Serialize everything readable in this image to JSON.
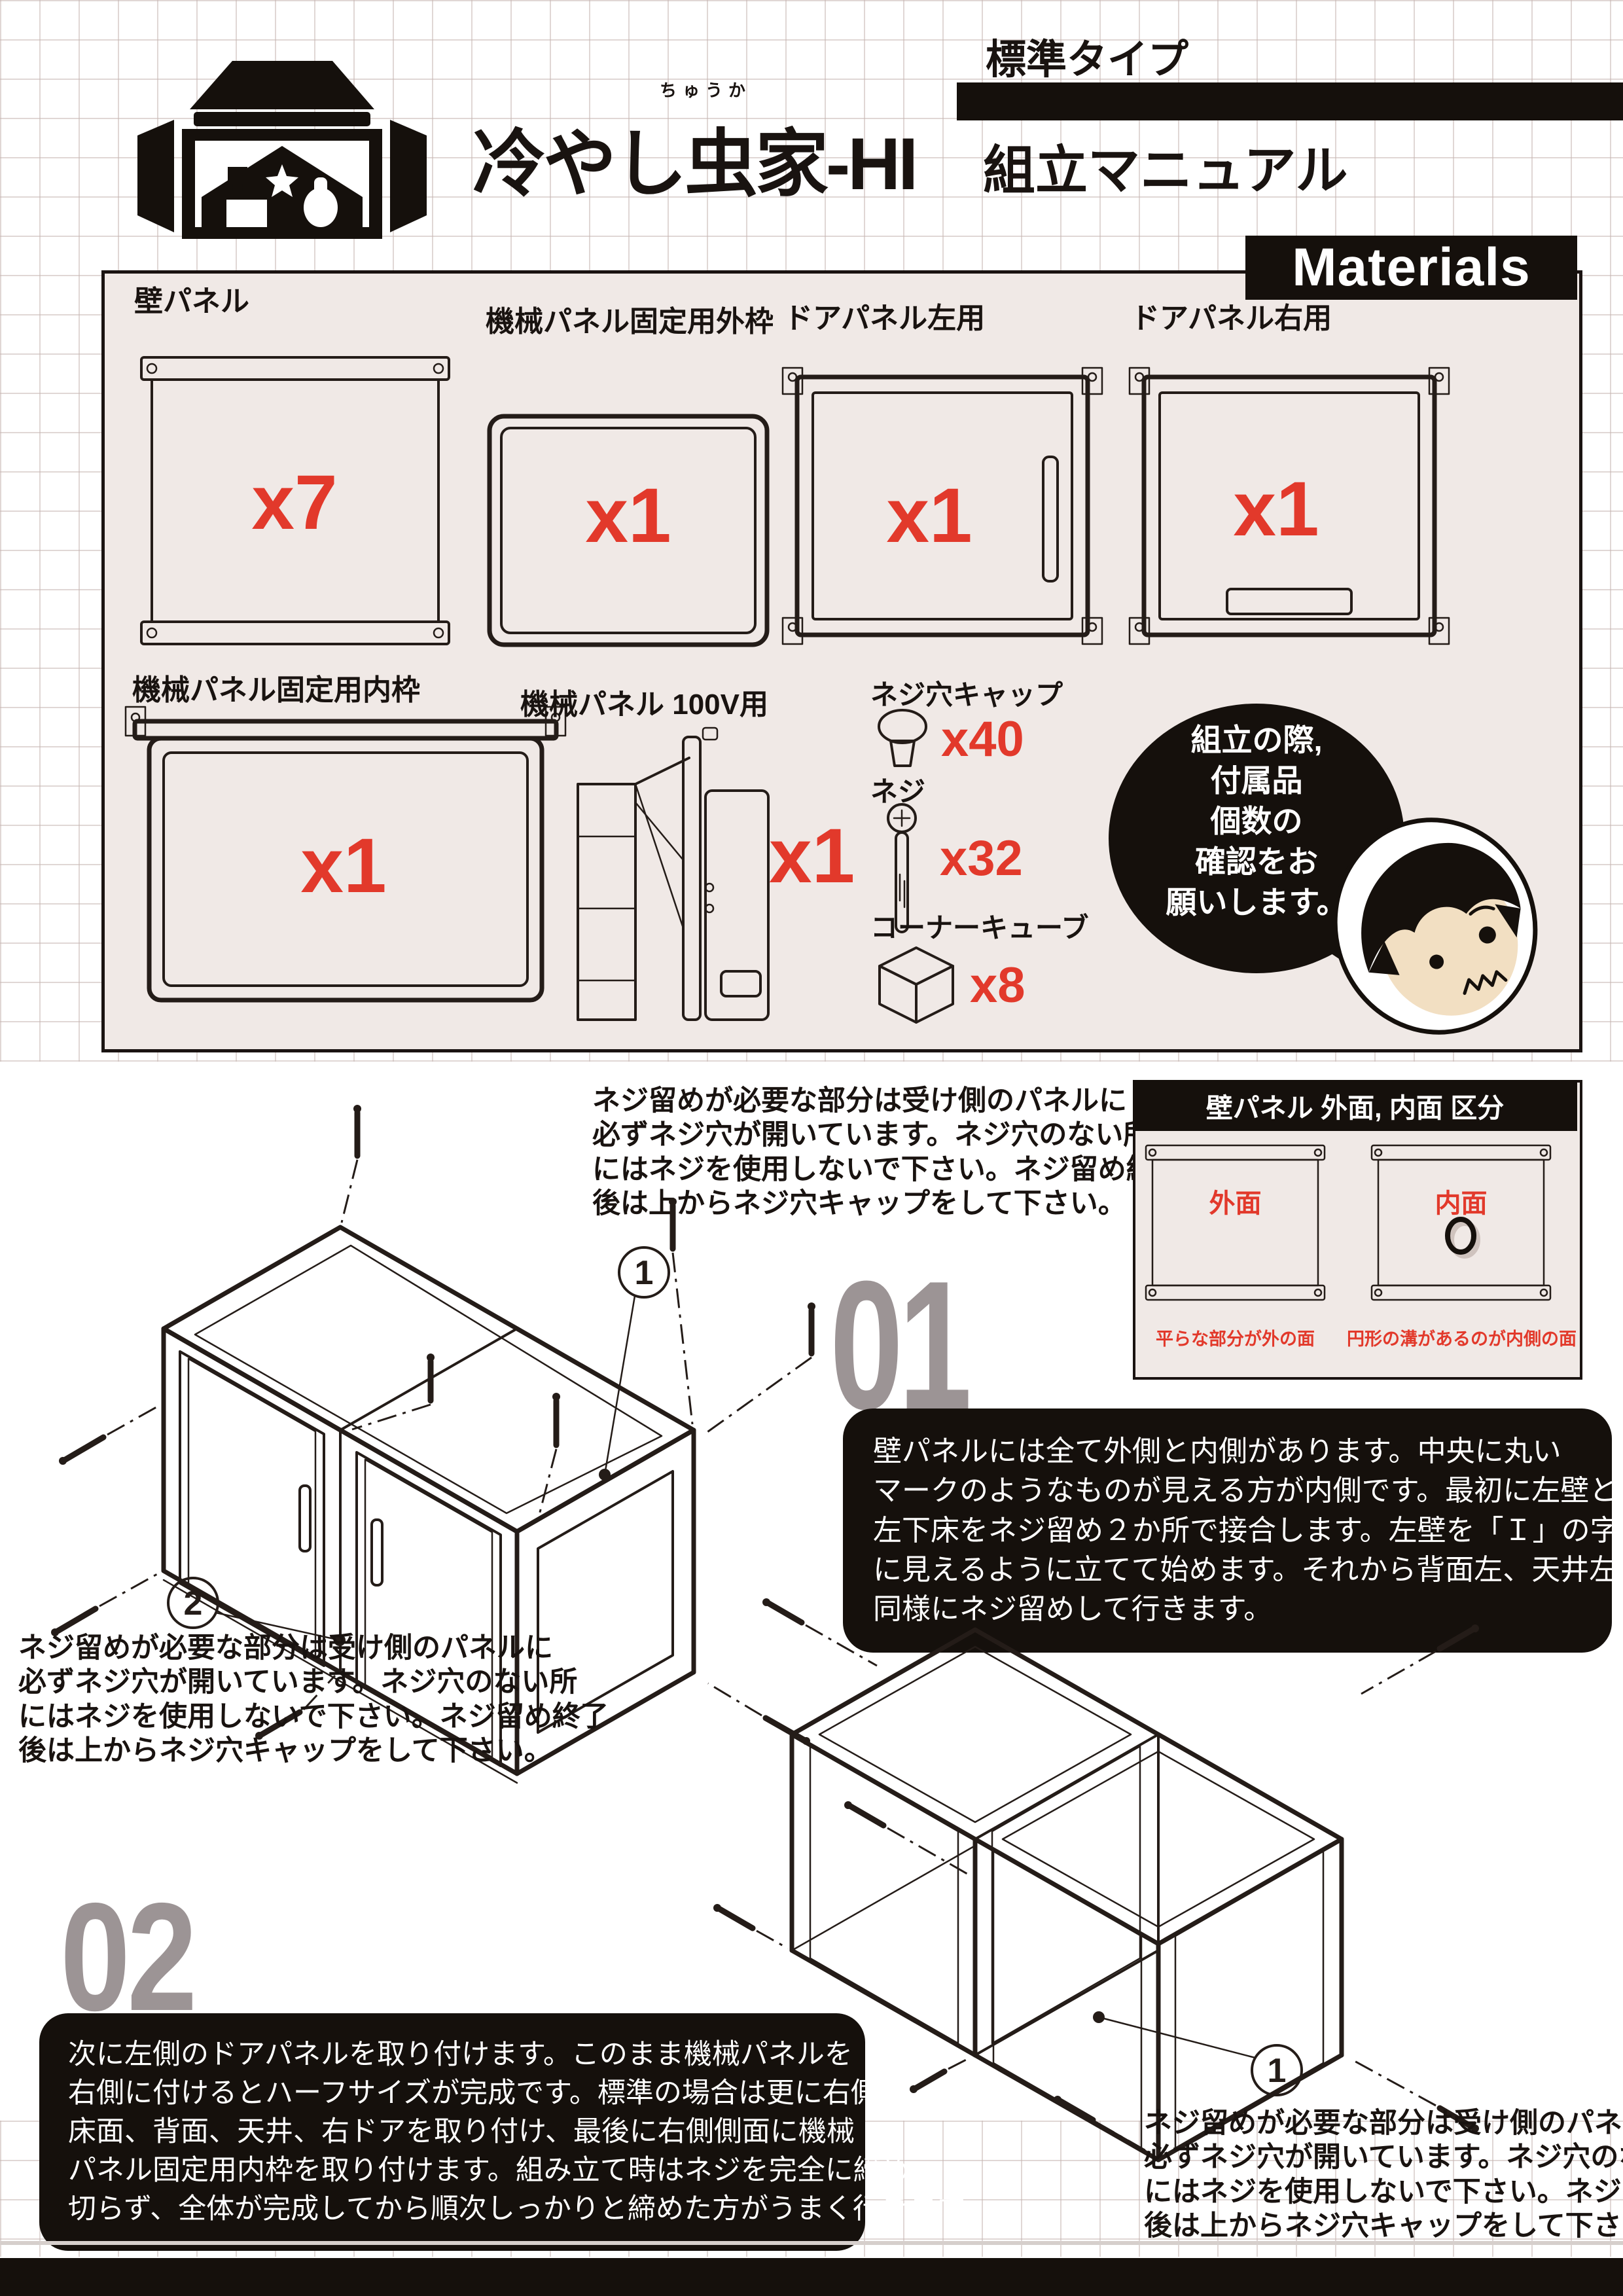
{
  "colors": {
    "accent_red": "#e2392b",
    "panel_bg": "#f0e9e6",
    "number_gray": "#9c9495",
    "ink": "#191310"
  },
  "header": {
    "brand": "冷やし虫家-HI",
    "brand_furigana": "ちゅうか",
    "type_label": "標準タイプ",
    "doc_title": "組立マニュアル"
  },
  "materials": {
    "tab_label": "Materials",
    "wall": {
      "label": "壁パネル",
      "count": "x7"
    },
    "outer_frame": {
      "label": "機械パネル固定用外枠",
      "count": "x1"
    },
    "door_left": {
      "label": "ドアパネル左用",
      "count": "x1"
    },
    "door_right": {
      "label": "ドアパネル右用",
      "count": "x1"
    },
    "inner_frame": {
      "label": "機械パネル固定用内枠",
      "count": "x1"
    },
    "machine": {
      "label": "機械パネル 100V用",
      "count": "x1"
    },
    "cap": {
      "label": "ネジ穴キャップ",
      "count": "x40"
    },
    "screw": {
      "label": "ネジ",
      "count": "x32"
    },
    "corner_cube": {
      "label": "コーナーキューブ",
      "count": "x8"
    },
    "bubble_lines": [
      "組立の際,",
      "付属品",
      "個数の",
      "確認をお",
      "願いします。"
    ]
  },
  "screw_note_lines": [
    "ネジ留めが必要な部分は受け側のパネルに",
    "必ずネジ穴が開いています。ネジ穴のない所",
    "にはネジを使用しないで下さい。ネジ留め終了",
    "後は上からネジ穴キャップをして下さい。"
  ],
  "panel_guide": {
    "title": "壁パネル 外面, 内面 区分",
    "outer_label": "外面",
    "inner_label": "内面",
    "outer_caption": "平らな部分が外の面",
    "inner_caption": "円形の溝があるのが内側の面"
  },
  "steps": {
    "step1": {
      "number": "01",
      "lines": [
        "壁パネルには全て外側と内側があります。中央に丸い",
        "マークのようなものが見える方が内側です。最初に左壁と",
        "左下床をネジ留め２か所で接合します。左壁を「Ｉ」の字",
        "に見えるように立てて始めます。それから背面左、天井左を",
        "同様にネジ留めして行きます。"
      ],
      "callout_1": "1",
      "callout_2": "2"
    },
    "step2": {
      "number": "02",
      "lines": [
        "次に左側のドアパネルを取り付けます。このまま機械パネルを",
        "右側に付けるとハーフサイズが完成です。標準の場合は更に右側の",
        "床面、背面、天井、右ドアを取り付け、最後に右側側面に機械",
        "パネル固定用内枠を取り付けます。組み立て時はネジを完全に締め",
        "切らず、全体が完成してから順次しっかりと締めた方がうまく行きます。"
      ],
      "callout_1": "1"
    }
  }
}
